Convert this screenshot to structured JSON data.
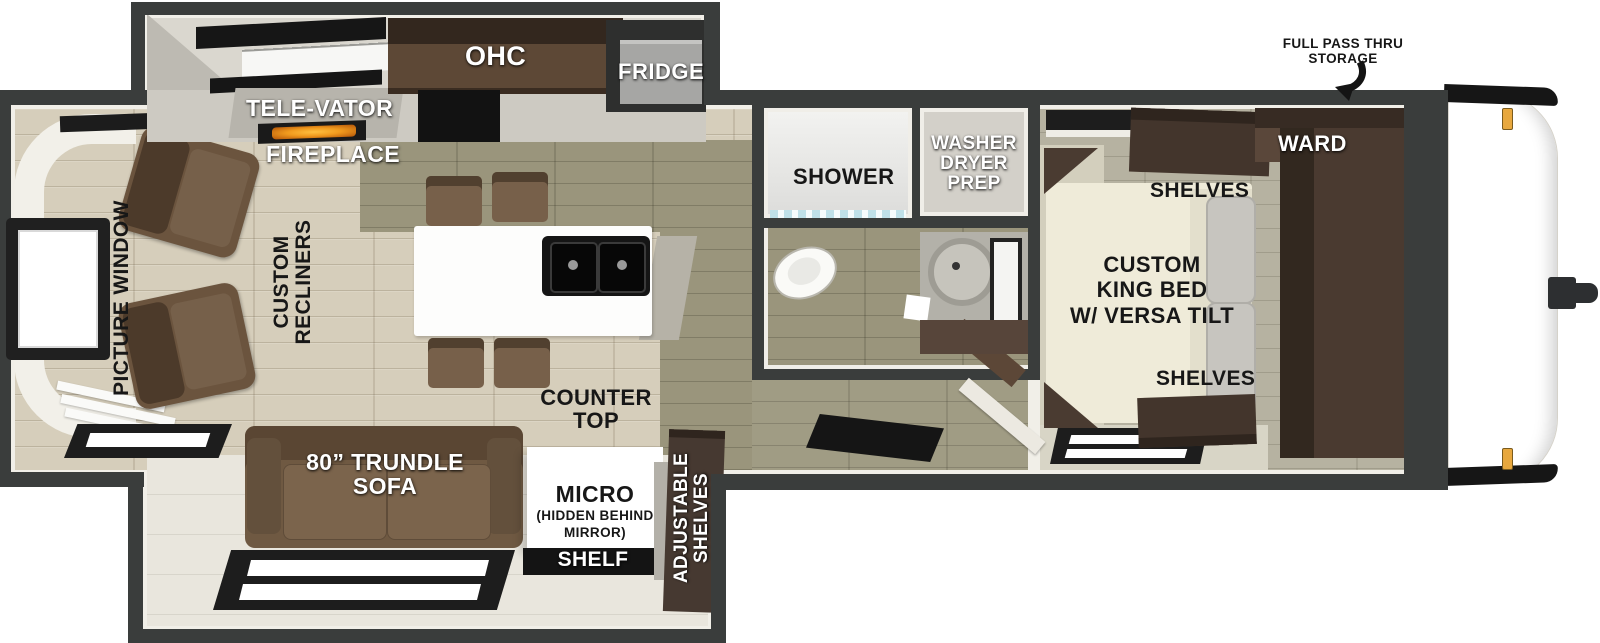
{
  "diagram": {
    "type": "rv-travel-trailer-floorplan",
    "view": "top-down",
    "colors": {
      "wall": "#3a3d3c",
      "lining": "#f1efe8",
      "floor_tan": "#d6cebb",
      "floor_olive": "#9a957c",
      "floor_bedroom": "#b6b2a1",
      "cabinet_dark_brown": "#43352c",
      "sofa_brown": "#6f5942",
      "fireplace_glow": "#f09a1e",
      "marker_light_amber": "#e8a83e",
      "bed_cream": "#efebd9",
      "island_white": "#fdfdfc"
    },
    "labels": {
      "storage_1": "FULL PASS THRU",
      "storage_2": "STORAGE",
      "tele_vator": "TELE-VATOR",
      "fireplace": "FIREPLACE",
      "ohc": "OHC",
      "fridge": "FRIDGE",
      "picture_window": "PICTURE WINDOW",
      "recliners_1": "CUSTOM",
      "recliners_2": "RECLINERS",
      "counter_1": "COUNTER",
      "counter_2": "TOP",
      "sofa_1": "80” TRUNDLE",
      "sofa_2": "SOFA",
      "micro": "MICRO",
      "micro_sub_1": "(HIDDEN BEHIND",
      "micro_sub_2": "MIRROR)",
      "shelf": "SHELF",
      "adj_1": "ADJUSTABLE",
      "adj_2": "SHELVES",
      "shower": "SHOWER",
      "washer_1": "WASHER",
      "washer_2": "DRYER",
      "washer_3": "PREP",
      "ward": "WARD",
      "shelves_top": "SHELVES",
      "shelves_bottom": "SHELVES",
      "bed_1": "CUSTOM",
      "bed_2": "KING BED",
      "bed_3": "W/ VERSA TILT"
    }
  }
}
